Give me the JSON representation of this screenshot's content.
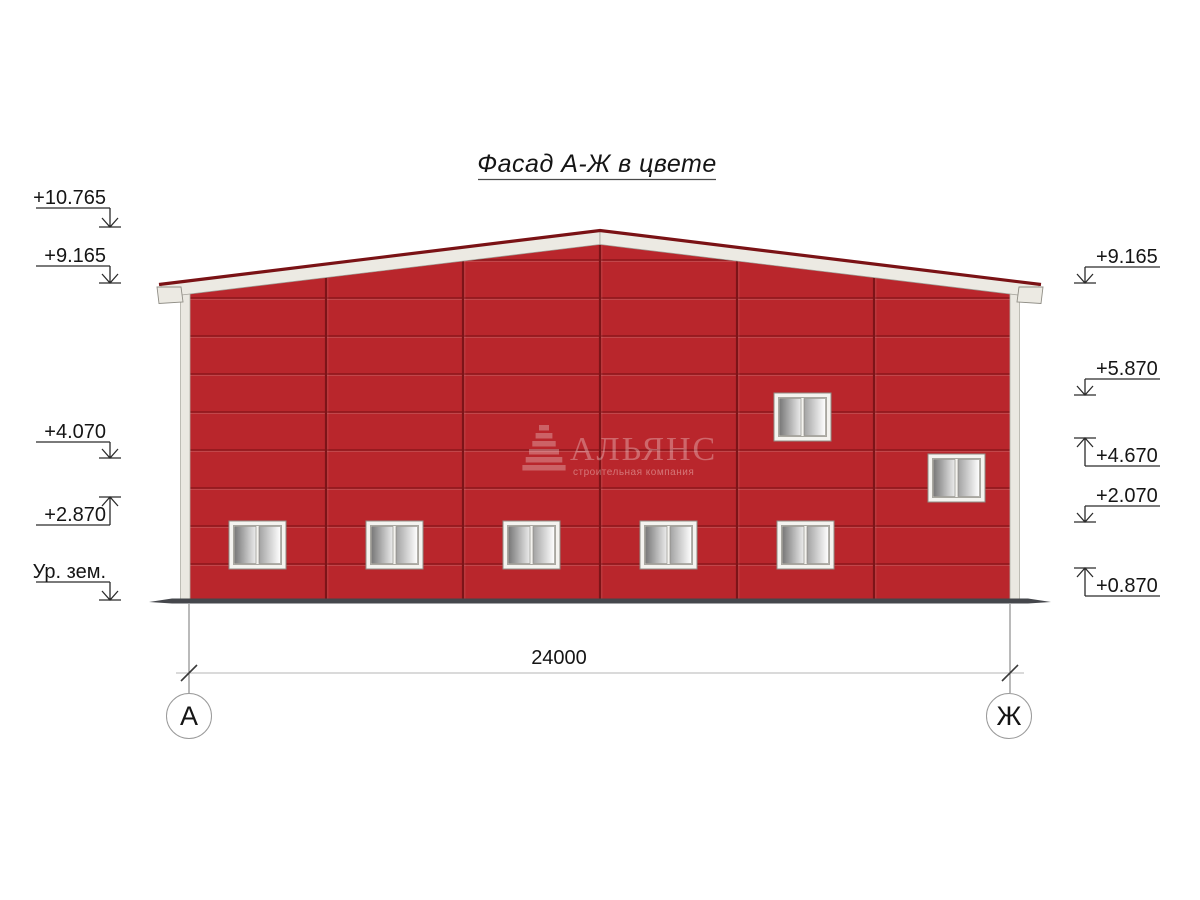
{
  "title": "Фасад А-Ж в цвете",
  "building": {
    "facade_color": "#b9262c",
    "panel_joint_color": "#7d1418",
    "roof_trim_color": "#eceae3",
    "roof_cap_color": "#7a1215",
    "corner_trim_color": "#eae8e1",
    "ground_color": "#45474c",
    "window_count": 7
  },
  "watermark": {
    "logo": "pyramid-logo",
    "name": "АЛЬЯНС",
    "subtitle": "строительная компания"
  },
  "levels_left": [
    {
      "label": "+10.765",
      "direction": "down"
    },
    {
      "label": "+9.165",
      "direction": "down"
    },
    {
      "label": "+4.070",
      "direction": "down"
    },
    {
      "label": "+2.870",
      "direction": "up"
    },
    {
      "label": "Ур. зем.",
      "direction": "down"
    }
  ],
  "levels_right": [
    {
      "label": "+9.165",
      "direction": "down"
    },
    {
      "label": "+5.870",
      "direction": "down"
    },
    {
      "label": "+4.670",
      "direction": "up"
    },
    {
      "label": "+2.070",
      "direction": "down"
    },
    {
      "label": "+0.870",
      "direction": "up"
    }
  ],
  "dimension": {
    "total": "24000"
  },
  "axes": {
    "left": "А",
    "right": "Ж"
  }
}
